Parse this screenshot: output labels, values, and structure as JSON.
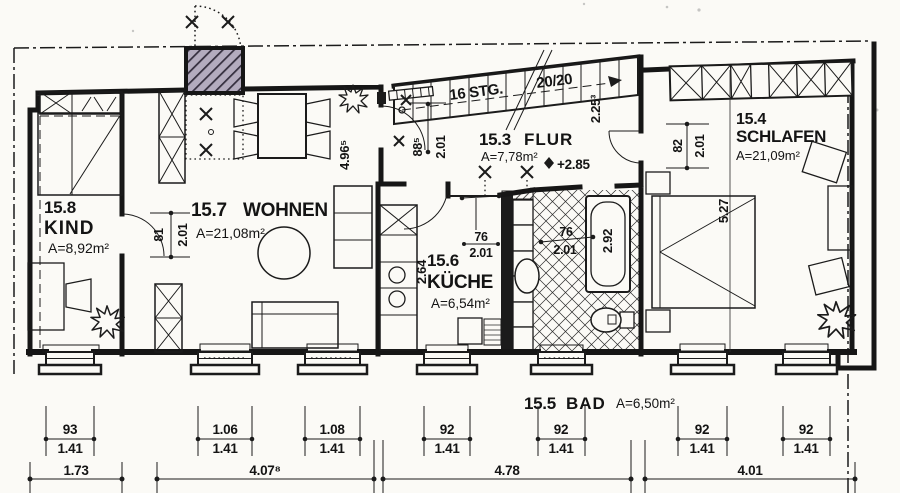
{
  "rooms": {
    "kind": {
      "num": "15.8",
      "name": "KIND",
      "area": "A=8,92m²"
    },
    "wohnen": {
      "num": "15.7",
      "name": "WOHNEN",
      "area": "A=21,08m²"
    },
    "flur": {
      "num": "15.3",
      "name": "FLUR",
      "area": "A=7,78m²"
    },
    "kueche": {
      "num": "15.6",
      "name": "KÜCHE",
      "area": "A=6,54m²"
    },
    "bad": {
      "num": "15.5",
      "name": "BAD",
      "area": "A=6,50m²"
    },
    "schlafen": {
      "num": "15.4",
      "name": "SCHLAFEN",
      "area": "A=21,09m²"
    }
  },
  "stairs": {
    "steps": "16 STG.",
    "ratio": "20/20"
  },
  "level_marker": "+2.85",
  "door_dims": {
    "kind": {
      "w": "81",
      "h": "2.01"
    },
    "wohnen_flur": {
      "w": "88⁵",
      "h": "2.01"
    },
    "kueche": {
      "w": "76",
      "h": "2.01"
    },
    "bad": {
      "w": "76",
      "h": "2.01"
    },
    "schlafen": {
      "w": "82",
      "h": "2.01"
    }
  },
  "room_dims": {
    "wohnen_height": "4.96⁵",
    "flur_width": "2.25³",
    "kueche_depth": "2.64",
    "bad_tub": "2.92",
    "schlafen_height": "5.27"
  },
  "window_dims": [
    {
      "w": "93",
      "h": "1.41"
    },
    {
      "w": "1.06",
      "h": "1.41"
    },
    {
      "w": "1.08",
      "h": "1.41"
    },
    {
      "w": "92",
      "h": "1.41"
    },
    {
      "w": "92",
      "h": "1.41"
    },
    {
      "w": "92",
      "h": "1.41"
    },
    {
      "w": "92",
      "h": "1.41"
    }
  ],
  "chain_dims": [
    {
      "value": "1.73"
    },
    {
      "value": "4.07⁸"
    },
    {
      "value": "4.78"
    },
    {
      "value": "4.01"
    }
  ],
  "colors": {
    "ink": "#1b1b1b",
    "paper": "#fbfaf6",
    "chimney_fill": "#b3abbe",
    "tile_line": "#2c2c2c"
  }
}
